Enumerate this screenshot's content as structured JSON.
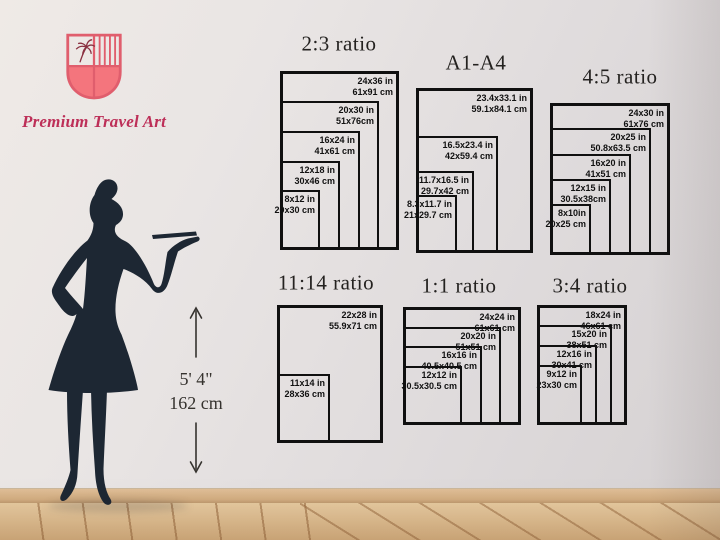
{
  "brand": {
    "name": "Premium Travel Art"
  },
  "model": {
    "height_imperial": "5' 4\"",
    "height_metric": "162 cm"
  },
  "colors": {
    "accent_pink": "#e05e6d",
    "shield_fill": "#f4757d",
    "brand_text": "#bd2f58",
    "silhouette": "#1d2733",
    "diagram_line": "#101010",
    "floor": "#dbb98c"
  },
  "icons": {
    "logo": "palm-tree-shield-icon",
    "height": "double-arrow-vertical-icon"
  },
  "panels": [
    {
      "title": "2:3 ratio",
      "title_x": 339,
      "title_y": 44,
      "left": 280,
      "bottom": 250,
      "sizes": [
        {
          "inches": "24x36 in",
          "cm": "61x91 cm",
          "w": 119,
          "h": 179
        },
        {
          "inches": "20x30 in",
          "cm": "51x76cm",
          "w": 99,
          "h": 149
        },
        {
          "inches": "16x24 in",
          "cm": "41x61 cm",
          "w": 80,
          "h": 119
        },
        {
          "inches": "12x18 in",
          "cm": "30x46 cm",
          "w": 60,
          "h": 89
        },
        {
          "inches": "8x12 in",
          "cm": "20x30 cm",
          "w": 40,
          "h": 60
        }
      ]
    },
    {
      "title": "A1-A4",
      "title_x": 476,
      "title_y": 63,
      "left": 416,
      "bottom": 253,
      "sizes": [
        {
          "inches": "23.4x33.1 in",
          "cm": "59.1x84.1 cm",
          "w": 117,
          "h": 165
        },
        {
          "inches": "16.5x23.4 in",
          "cm": "42x59.4 cm",
          "w": 82,
          "h": 117
        },
        {
          "inches": "11.7x16.5 in",
          "cm": "29.7x42 cm",
          "w": 58,
          "h": 82
        },
        {
          "inches": "8.3x11.7 in",
          "cm": "21x29.7 cm",
          "w": 41,
          "h": 58
        }
      ]
    },
    {
      "title": "4:5 ratio",
      "title_x": 620,
      "title_y": 77,
      "left": 550,
      "bottom": 255,
      "sizes": [
        {
          "inches": "24x30 in",
          "cm": "61x76 cm",
          "w": 120,
          "h": 152
        },
        {
          "inches": "20x25 in",
          "cm": "50.8x63.5 cm",
          "w": 101,
          "h": 127
        },
        {
          "inches": "16x20 in",
          "cm": "41x51 cm",
          "w": 81,
          "h": 101
        },
        {
          "inches": "12x15 in",
          "cm": "30.5x38cm",
          "w": 61,
          "h": 76
        },
        {
          "inches": "8x10in",
          "cm": "20x25 cm",
          "w": 41,
          "h": 51
        }
      ]
    },
    {
      "title": "11:14 ratio",
      "title_x": 326,
      "title_y": 283,
      "left": 277,
      "bottom": 443,
      "sizes": [
        {
          "inches": "22x28 in",
          "cm": "55.9x71 cm",
          "w": 106,
          "h": 138
        },
        {
          "inches": "11x14 in",
          "cm": "28x36 cm",
          "w": 53,
          "h": 69
        }
      ]
    },
    {
      "title": "1:1 ratio",
      "title_x": 459,
      "title_y": 286,
      "left": 403,
      "bottom": 425,
      "sizes": [
        {
          "inches": "24x24 in",
          "cm": "61x61 cm",
          "w": 118,
          "h": 118
        },
        {
          "inches": "20x20 in",
          "cm": "51x51 cm",
          "w": 98,
          "h": 98
        },
        {
          "inches": "16x16 in",
          "cm": "40.5x40.5 cm",
          "w": 79,
          "h": 79
        },
        {
          "inches": "12x12 in",
          "cm": "30.5x30.5 cm",
          "w": 59,
          "h": 59
        }
      ]
    },
    {
      "title": "3:4 ratio",
      "title_x": 590,
      "title_y": 286,
      "left": 537,
      "bottom": 425,
      "sizes": [
        {
          "inches": "18x24 in",
          "cm": "46x61 cm",
          "w": 90,
          "h": 120
        },
        {
          "inches": "15x20 in",
          "cm": "38x51 cm",
          "w": 75,
          "h": 100
        },
        {
          "inches": "12x16 in",
          "cm": "30x41 cm",
          "w": 60,
          "h": 80
        },
        {
          "inches": "9x12 in",
          "cm": "23x30 cm",
          "w": 45,
          "h": 60
        }
      ]
    }
  ]
}
